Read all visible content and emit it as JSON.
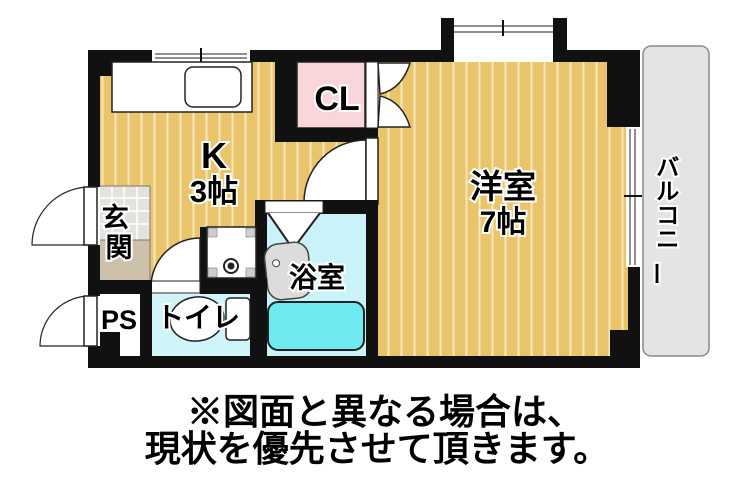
{
  "rooms": {
    "kitchen": {
      "label": "K",
      "size": "3帖"
    },
    "closet": {
      "label": "CL"
    },
    "western_room": {
      "label": "洋室",
      "size": "7帖"
    },
    "entrance": {
      "label": "玄関",
      "chars": [
        "玄",
        "関"
      ]
    },
    "pipe_space": {
      "label": "PS"
    },
    "toilet": {
      "label": "トイレ"
    },
    "bathroom": {
      "label": "浴室"
    },
    "balcony": {
      "label": "バルコニー",
      "chars": [
        "バ",
        "ル",
        "コ",
        "ニ",
        "ー"
      ]
    }
  },
  "disclaimer": {
    "line1": "※図面と異なる場合は、",
    "line2": "現状を優先させて頂きます。"
  },
  "colors": {
    "wall": "#111111",
    "floor": "#e9c46a",
    "floor_stripe": "#f6e7bd",
    "closet_pink": "#f8d6da",
    "bathroom_floor": "#c9f3f8",
    "bathtub": "#6fe9f0",
    "toilet_floor": "#cff5f9",
    "balcony_gray": "#e4e4e4",
    "entrance_tile": "#e3e3de",
    "entrance_step": "#cdc1ab",
    "fixture_gray": "#dcdcdc",
    "window_line": "#909090"
  }
}
